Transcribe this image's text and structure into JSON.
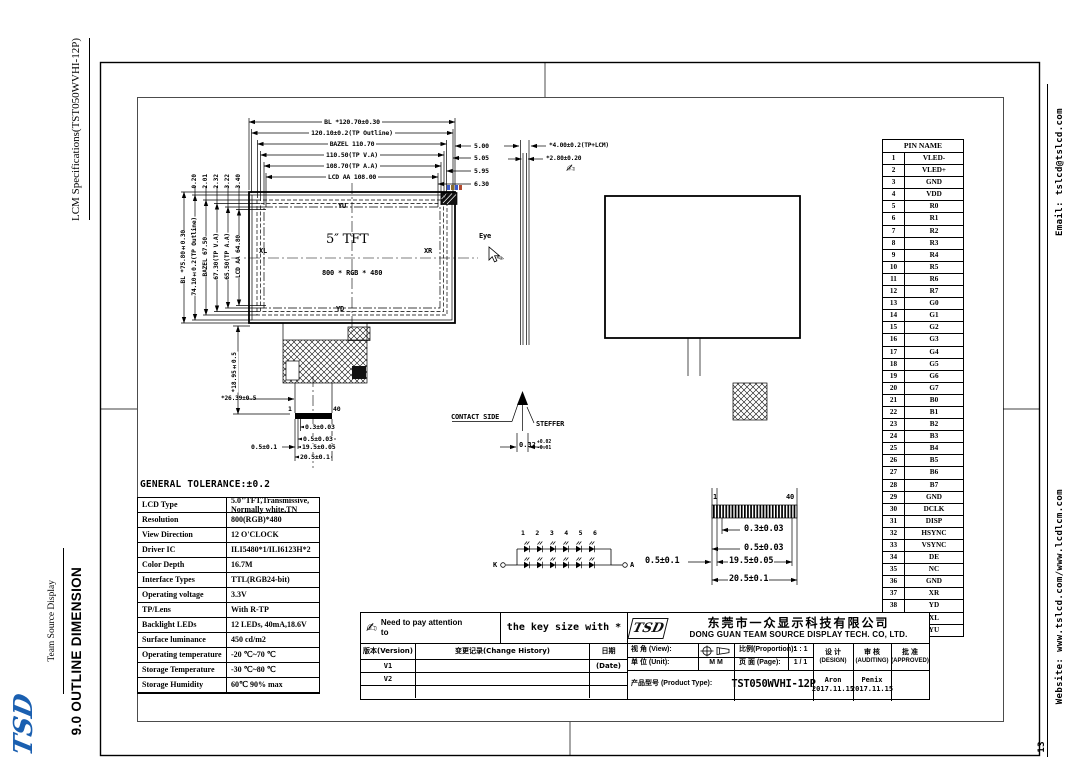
{
  "page": {
    "number": "13"
  },
  "sidebar_left": {
    "doc_title": "LCM Specifications(TST050WVHI-12P)",
    "brand": "Team Source Display",
    "section": "9.0 OUTLINE DIMENSION",
    "logo": "TSD"
  },
  "sidebar_right": {
    "email": "Email: tslcd@tslcd.com",
    "website": "Website: www.tslcd.com/www.lcdlcm.com"
  },
  "front_view": {
    "top_dims": [
      "BL *120.70±0.30",
      "120.10±0.2(TP Outline)",
      "BAZEL 110.70",
      "110.50(TP V.A)",
      "108.70(TP A.A)",
      "LCD AA 108.00"
    ],
    "right_gaps": [
      "5.00",
      "5.05",
      "5.95",
      "6.30"
    ],
    "left_dims": [
      "BL *75.80±0.30",
      "74.10±0.2(TP Outline)",
      "BAZEL 67.50",
      "67.30(TP V.A)",
      "65.50(TP A.A)",
      "LCD AA 64.80"
    ],
    "top_gaps": [
      "0.20",
      "2.01",
      "2.32",
      "3.22",
      "3.40"
    ],
    "labels": {
      "yu": "YU",
      "xl": "XL",
      "xr": "XR",
      "yd": "YD",
      "size": "5″ TFT",
      "resolution": "800 * RGB * 480"
    },
    "fpc": {
      "height_dim": "*18.95±0.5",
      "width_dim": "*26.39±0.5",
      "pin1": "1",
      "pin40": "40",
      "pitch": "0.3±0.03",
      "pin_w": "0.5±0.03",
      "margin": "0.5±0.1",
      "span": "19.5±0.05",
      "total": "20.5±0.1"
    }
  },
  "side_view": {
    "dim_total": "*4.00±0.2(TP+LCM)",
    "dim_lcm": "*2.80±0.20",
    "eye": "Eye",
    "contact": "CONTACT SIDE",
    "stiffener": "STEFFER",
    "thickness": "0.32",
    "tol_plus": "+0.02",
    "tol_minus": "-0.01"
  },
  "detail_view": {
    "pin1": "1",
    "pin40": "40",
    "pitch": "0.3±0.03",
    "pin_w": "0.5±0.03",
    "margin": "0.5±0.1",
    "span": "19.5±0.05",
    "total": "20.5±0.1"
  },
  "led_circuit": {
    "numbers": [
      "1",
      "2",
      "3",
      "4",
      "5",
      "6"
    ],
    "k": "K",
    "a": "A"
  },
  "general_tolerance": "GENERAL TOLERANCE:±0.2",
  "pin_table": {
    "header": "PIN NAME",
    "pins": [
      {
        "n": "1",
        "name": "VLED-"
      },
      {
        "n": "2",
        "name": "VLED+"
      },
      {
        "n": "3",
        "name": "GND"
      },
      {
        "n": "4",
        "name": "VDD"
      },
      {
        "n": "5",
        "name": "R0"
      },
      {
        "n": "6",
        "name": "R1"
      },
      {
        "n": "7",
        "name": "R2"
      },
      {
        "n": "8",
        "name": "R3"
      },
      {
        "n": "9",
        "name": "R4"
      },
      {
        "n": "10",
        "name": "R5"
      },
      {
        "n": "11",
        "name": "R6"
      },
      {
        "n": "12",
        "name": "R7"
      },
      {
        "n": "13",
        "name": "G0"
      },
      {
        "n": "14",
        "name": "G1"
      },
      {
        "n": "15",
        "name": "G2"
      },
      {
        "n": "16",
        "name": "G3"
      },
      {
        "n": "17",
        "name": "G4"
      },
      {
        "n": "18",
        "name": "G5"
      },
      {
        "n": "19",
        "name": "G6"
      },
      {
        "n": "20",
        "name": "G7"
      },
      {
        "n": "21",
        "name": "B0"
      },
      {
        "n": "22",
        "name": "B1"
      },
      {
        "n": "23",
        "name": "B2"
      },
      {
        "n": "24",
        "name": "B3"
      },
      {
        "n": "25",
        "name": "B4"
      },
      {
        "n": "26",
        "name": "B5"
      },
      {
        "n": "27",
        "name": "B6"
      },
      {
        "n": "28",
        "name": "B7"
      },
      {
        "n": "29",
        "name": "GND"
      },
      {
        "n": "30",
        "name": "DCLK"
      },
      {
        "n": "31",
        "name": "DISP"
      },
      {
        "n": "32",
        "name": "HSYNC"
      },
      {
        "n": "33",
        "name": "VSYNC"
      },
      {
        "n": "34",
        "name": "DE"
      },
      {
        "n": "35",
        "name": "NC"
      },
      {
        "n": "36",
        "name": "GND"
      },
      {
        "n": "37",
        "name": "XR"
      },
      {
        "n": "38",
        "name": "YD"
      },
      {
        "n": "39",
        "name": "XL"
      },
      {
        "n": "40",
        "name": "YU"
      }
    ]
  },
  "spec_table": {
    "rows": [
      {
        "label": "LCD Type",
        "value": "5.0\"TFT,Transmissive, Normally white,TN"
      },
      {
        "label": "Resolution",
        "value": "800(RGB)*480"
      },
      {
        "label": "View Direction",
        "value": "12 O'CLOCK"
      },
      {
        "label": "Driver IC",
        "value": "ILI5480*1/ILI6123H*2"
      },
      {
        "label": "Color Depth",
        "value": "16.7M"
      },
      {
        "label": "Interface Types",
        "value": "TTL(RGB24-bit)"
      },
      {
        "label": "Operating voltage",
        "value": "3.3V"
      },
      {
        "label": "TP/Lens",
        "value": "With R-TP"
      },
      {
        "label": "Backlight LEDs",
        "value": "12 LEDs, 40mA,18.6V"
      },
      {
        "label": "Surface luminance",
        "value": "450 cd/m2"
      },
      {
        "label": "Operating temperature",
        "value": "-20 ℃~70 ℃"
      },
      {
        "label": "Storage Temperature",
        "value": "-30 ℃~80 ℃"
      },
      {
        "label": "Storage Humidity",
        "value": "60℃ 90% max"
      }
    ]
  },
  "title_block": {
    "attention": "Need to pay attention to",
    "key_note": "the key size with *",
    "version_header": [
      "版本(Version)",
      "变更记录(Change History)",
      "日期(Date)"
    ],
    "versions": [
      "V1",
      "V2"
    ],
    "company_cn": "东莞市一众显示科技有限公司",
    "company_en": "DONG GUAN TEAM SOURCE DISPLAY TECH. CO, LTD.",
    "logo": "TSD",
    "view_label": "视 角 (View):",
    "unit_label": "单 位 (Unit):",
    "unit": "M M",
    "proportion_label": "比例(Proportion):",
    "proportion": "1 : 1",
    "page_label": "页 面 (Page):",
    "page": "1 / 1",
    "product_label": "产品型号 (Product Type):",
    "product": "TST050WVHI-12P",
    "design_label": "设 计",
    "design_sub": "(DESIGN)",
    "audit_label": "审 核",
    "audit_sub": "(AUDITING)",
    "approve_label": "批 准",
    "approve_sub": "(APPROVED)",
    "design_name": "Aron",
    "design_date": "2017.11.15",
    "audit_name": "Penix",
    "audit_date": "2017.11.15"
  },
  "icons": {
    "attention_hand": "✍",
    "note_hand": "✍",
    "pen": "✎"
  }
}
